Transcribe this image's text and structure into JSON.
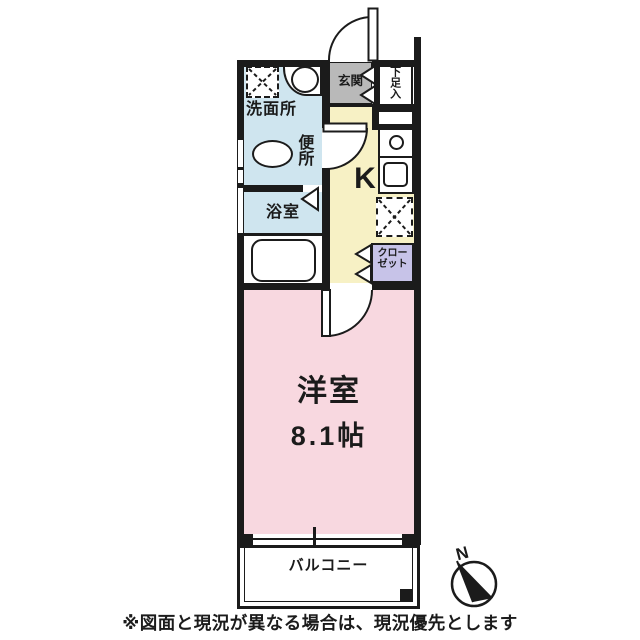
{
  "plan": {
    "rooms": {
      "washroom": {
        "label": "洗面所",
        "color": "#cfe5ef"
      },
      "toilet": {
        "label": "便所"
      },
      "bath": {
        "label": "浴室",
        "color": "#cfe5ef"
      },
      "entrance": {
        "label": "玄関",
        "color": "#b9b9b9"
      },
      "shoe_cabinet": {
        "label": "下足入"
      },
      "kitchen": {
        "label": "K",
        "color": "#f7f1c5"
      },
      "closet": {
        "line1": "クロー",
        "line2": "ゼット",
        "color": "#c7c3e8"
      },
      "main_room": {
        "label": "洋室",
        "size": "8.1帖",
        "color": "#f8d8e0"
      },
      "balcony": {
        "label": "バルコニー"
      }
    },
    "compass": {
      "label": "N"
    },
    "wall_color": "#1b1b1b",
    "fixtures": [
      "washing-machine-space",
      "basin",
      "toilet",
      "bathtub",
      "stove",
      "kitchen-sink",
      "refrigerator-space"
    ]
  },
  "footer": {
    "note": "※図面と現況が異なる場合は、現況優先とします"
  }
}
